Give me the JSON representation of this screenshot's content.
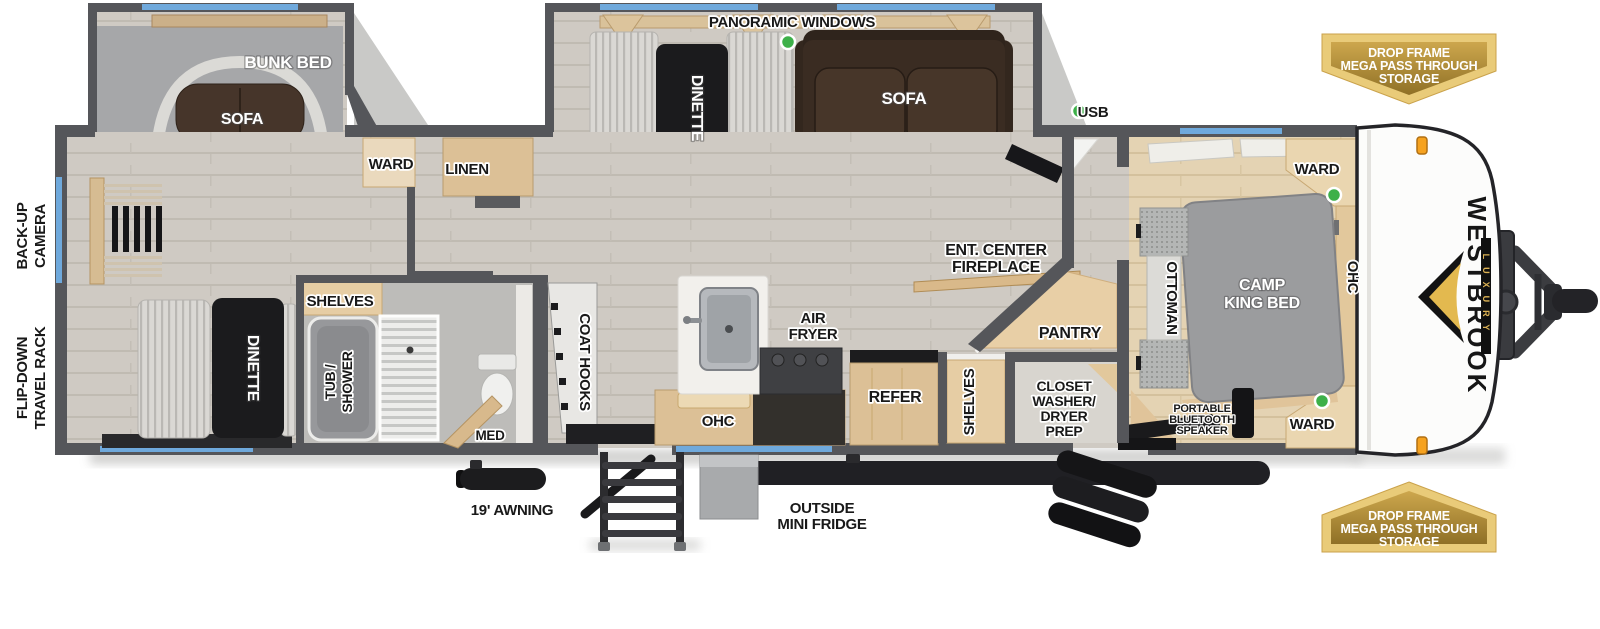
{
  "brand": {
    "name": "WESTBROOK",
    "sub": "LUXURY"
  },
  "storage_badge": {
    "lines": [
      "DROP FRAME",
      "MEGA PASS THROUGH",
      "STORAGE"
    ]
  },
  "labels": {
    "panoramic_windows": "PANORAMIC WINDOWS",
    "bunk_bed": "BUNK BED",
    "sofa": "SOFA",
    "ward": "WARD",
    "linen": "LINEN",
    "back_up_camera": [
      "BACK-UP",
      "CAMERA"
    ],
    "flip_down_travel_rack": [
      "FLIP-DOWN",
      "TRAVEL RACK"
    ],
    "dinette": "DINETTE",
    "usb": "USB",
    "ent_center_fireplace": [
      "ENT. CENTER",
      "FIREPLACE"
    ],
    "pantry": "PANTRY",
    "shelves": "SHELVES",
    "closet_washer_dryer_prep": [
      "CLOSET",
      "WASHER/",
      "DRYER",
      "PREP"
    ],
    "tub_shower": [
      "TUB /",
      "SHOWER"
    ],
    "med": "MED",
    "coat_hooks": "COAT HOOKS",
    "ohc": "OHC",
    "air_fryer": [
      "AIR",
      "FRYER"
    ],
    "refer": "REFER",
    "outside_mini_fridge": [
      "OUTSIDE",
      "MINI FRIDGE"
    ],
    "awning": "19' AWNING",
    "ottoman": "OTTOMAN",
    "camp_king_bed": [
      "CAMP",
      "KING BED"
    ],
    "portable_bluetooth_speaker": [
      "PORTABLE",
      "BLUETOOTH",
      "SPEAKER"
    ]
  },
  "colors": {
    "wall_gray": "#55565a",
    "window_blue": "#6fa9dc",
    "indicator_green": "#3db049",
    "badge_gold_light": "#e9cb79",
    "badge_gold": "#b8933e",
    "brand_gold": "#e3b94f",
    "marker_amber": "#f6a21f",
    "floor_gray": "#cfcac3",
    "floor_tan": "#e4d3b3",
    "cabinet_wood": "#dcc096",
    "sofa_brown": "#3a2c22"
  }
}
